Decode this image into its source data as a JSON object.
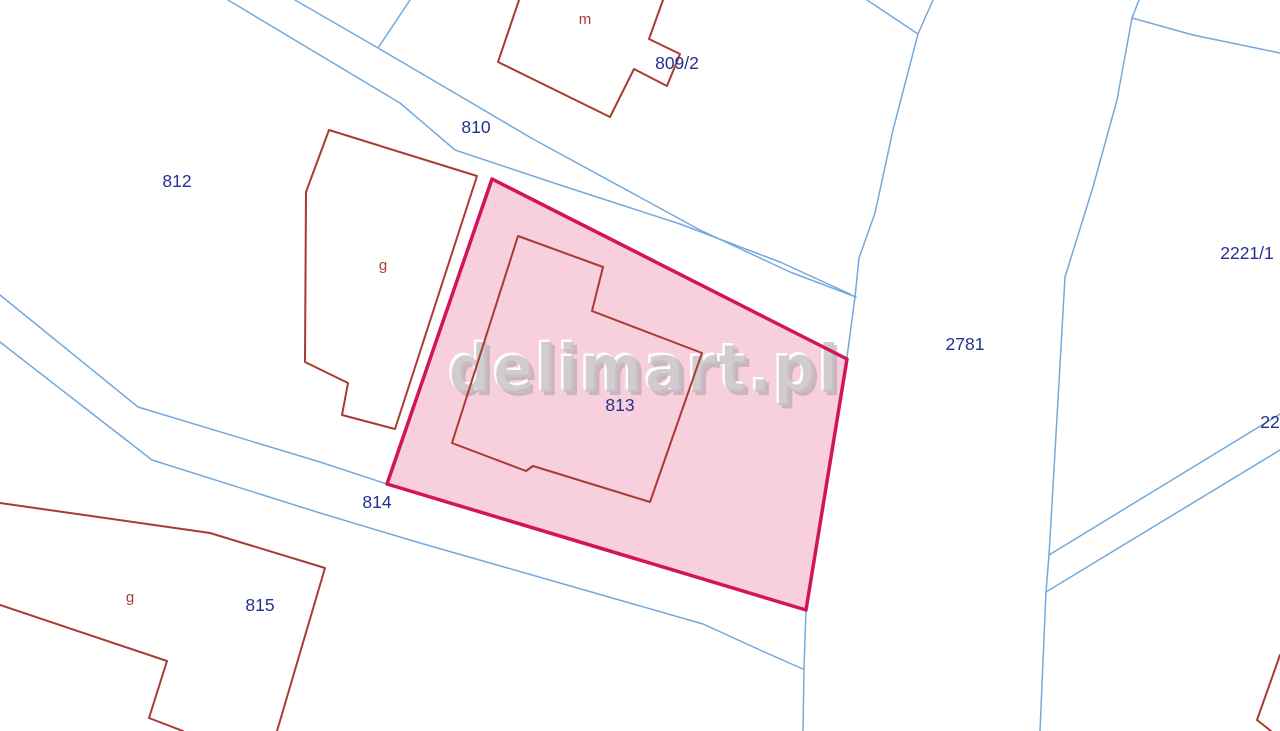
{
  "map": {
    "width": 1280,
    "height": 731,
    "background": "#ffffff",
    "colors": {
      "parcel_boundary_blue": "#74A9DC",
      "building_outline_red": "#A93B32",
      "selected_parcel_stroke": "#D4145A",
      "selected_parcel_fill": "#F8CFDD",
      "parcel_label_navy": "#24308F",
      "building_label_red": "#AC3A35",
      "watermark_gray": "#C8C2C6",
      "watermark_highlight": "#FFFFFF",
      "watermark_shadow": "#A29AA0"
    },
    "watermark": {
      "text": "delimart.pl",
      "x": 645,
      "y": 392,
      "font_size": 66,
      "text_length": 392
    },
    "selected_parcel": {
      "id": "813",
      "points": [
        [
          492,
          179
        ],
        [
          847,
          359
        ],
        [
          806,
          610
        ],
        [
          387,
          484
        ]
      ],
      "stroke_width": 3.5,
      "label": {
        "text": "813",
        "x": 620,
        "y": 411
      }
    },
    "boundary_lines": [
      {
        "name": "road-810-upper-edge",
        "points": [
          [
            295,
            0
          ],
          [
            378,
            48
          ],
          [
            533,
            139
          ],
          [
            700,
            230
          ],
          [
            790,
            272
          ],
          [
            856,
            297
          ]
        ]
      },
      {
        "name": "road-810-lower-edge",
        "points": [
          [
            228,
            0
          ],
          [
            400,
            103
          ],
          [
            455,
            150
          ],
          [
            560,
            185
          ],
          [
            680,
            224
          ],
          [
            780,
            262
          ],
          [
            850,
            294
          ]
        ]
      },
      {
        "name": "road-810-top-branch",
        "points": [
          [
            410,
            0
          ],
          [
            378,
            48
          ]
        ]
      },
      {
        "name": "parcel-2781-west-boundary",
        "points": [
          [
            933,
            0
          ],
          [
            918,
            34
          ],
          [
            893,
            130
          ],
          [
            875,
            213
          ],
          [
            859,
            258
          ],
          [
            855,
            297
          ],
          [
            847,
            357
          ]
        ]
      },
      {
        "name": "top-fork-branch",
        "points": [
          [
            867,
            0
          ],
          [
            918,
            34
          ]
        ]
      },
      {
        "name": "boundary-below-parcel-813",
        "points": [
          [
            806,
            610
          ],
          [
            804,
            669
          ],
          [
            803,
            731
          ]
        ]
      },
      {
        "name": "road-814-upper-edge",
        "points": [
          [
            0,
            295
          ],
          [
            138,
            407
          ],
          [
            320,
            462
          ],
          [
            387,
            484
          ]
        ]
      },
      {
        "name": "road-814-lower-edge",
        "points": [
          [
            0,
            342
          ],
          [
            152,
            460
          ],
          [
            320,
            513
          ],
          [
            420,
            543
          ],
          [
            560,
            583
          ],
          [
            703,
            624
          ],
          [
            760,
            650
          ],
          [
            803,
            669
          ]
        ]
      },
      {
        "name": "parcel-2781-east-boundary",
        "points": [
          [
            1139,
            0
          ],
          [
            1132,
            18
          ],
          [
            1117,
            100
          ],
          [
            1093,
            187
          ],
          [
            1065,
            277
          ],
          [
            1058,
            400
          ],
          [
            1049,
            555
          ],
          [
            1046,
            592
          ],
          [
            1040,
            731
          ]
        ]
      },
      {
        "name": "northeast-branch",
        "points": [
          [
            1132,
            18
          ],
          [
            1193,
            35
          ],
          [
            1280,
            53
          ]
        ]
      },
      {
        "name": "southeast-diagonal-upper",
        "points": [
          [
            1049,
            555
          ],
          [
            1280,
            414
          ]
        ]
      },
      {
        "name": "southeast-diagonal-lower",
        "points": [
          [
            1046,
            592
          ],
          [
            1280,
            450
          ]
        ]
      }
    ],
    "buildings": [
      {
        "name": "building-m-outline",
        "closed": false,
        "points": [
          [
            519,
            0
          ],
          [
            498,
            62
          ],
          [
            610,
            117
          ],
          [
            634,
            69
          ],
          [
            667,
            86
          ],
          [
            680,
            54
          ],
          [
            649,
            39
          ],
          [
            663,
            0
          ]
        ]
      },
      {
        "name": "building-g-812-outline",
        "closed": true,
        "points": [
          [
            329,
            130
          ],
          [
            477,
            176
          ],
          [
            395,
            429
          ],
          [
            342,
            415
          ],
          [
            348,
            383
          ],
          [
            305,
            362
          ],
          [
            306,
            192
          ]
        ]
      },
      {
        "name": "building-h-813-outline",
        "closed": true,
        "points": [
          [
            518,
            236
          ],
          [
            603,
            267
          ],
          [
            592,
            311
          ],
          [
            702,
            353
          ],
          [
            650,
            502
          ],
          [
            533,
            466
          ],
          [
            526,
            471
          ],
          [
            452,
            443
          ]
        ]
      },
      {
        "name": "building-g-815-outline-main",
        "closed": false,
        "points": [
          [
            0,
            503
          ],
          [
            210,
            533
          ],
          [
            325,
            568
          ],
          [
            277,
            731
          ]
        ]
      },
      {
        "name": "building-g-815-outline-annex",
        "closed": false,
        "points": [
          [
            0,
            605
          ],
          [
            167,
            661
          ],
          [
            149,
            718
          ],
          [
            183,
            731
          ]
        ]
      },
      {
        "name": "building-corner-bottom-right",
        "closed": false,
        "points": [
          [
            1280,
            655
          ],
          [
            1257,
            720
          ],
          [
            1271,
            731
          ]
        ]
      }
    ],
    "parcel_labels": [
      {
        "text": "812",
        "x": 177,
        "y": 187
      },
      {
        "text": "810",
        "x": 476,
        "y": 133
      },
      {
        "text": "809/2",
        "x": 677,
        "y": 69
      },
      {
        "text": "2221/1",
        "x": 1247,
        "y": 259
      },
      {
        "text": "2781",
        "x": 965,
        "y": 350
      },
      {
        "text": "814",
        "x": 377,
        "y": 508
      },
      {
        "text": "815",
        "x": 260,
        "y": 611
      },
      {
        "text": "22",
        "x": 1270,
        "y": 428
      }
    ],
    "building_labels": [
      {
        "text": "m",
        "x": 585,
        "y": 24
      },
      {
        "text": "g",
        "x": 383,
        "y": 270
      },
      {
        "text": "g",
        "x": 130,
        "y": 602
      }
    ],
    "faint_building_label": {
      "text": "h",
      "x": 570,
      "y": 379
    }
  }
}
